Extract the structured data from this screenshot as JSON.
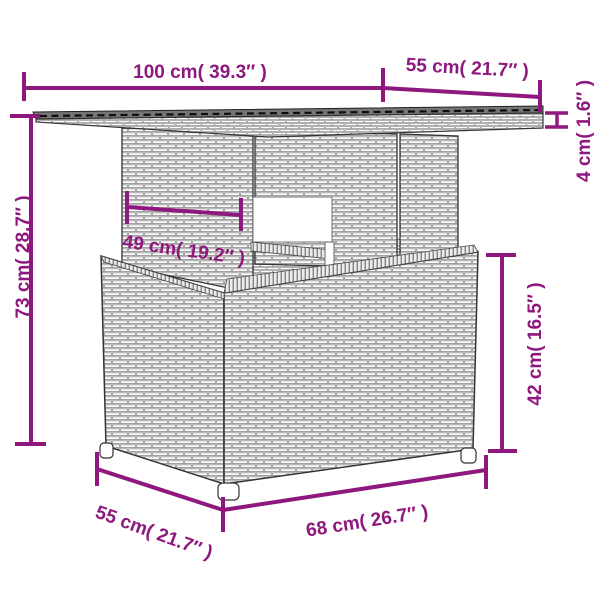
{
  "page": {
    "background": "#ffffff",
    "description": "Dimension diagram of a poly rattan garden table with glass top"
  },
  "colors": {
    "dimension_annotation": "#8E187D",
    "drawing_outline": "#3a3a3a",
    "glass_top": "#757575",
    "weave_line": "#8a8a8a"
  },
  "dimensions": {
    "top_width": "100 cm( 39.3″ )",
    "top_depth": "55 cm( 21.7″ )",
    "top_thickness": "4 cm( 1.6″ )",
    "total_height": "73 cm( 28.7″ )",
    "pedestal_width": "49 cm( 19.2″ )",
    "base_height": "42 cm( 16.5″ )",
    "base_depth": "55 cm( 21.7″ )",
    "base_width": "68 cm( 26.7″ )"
  }
}
